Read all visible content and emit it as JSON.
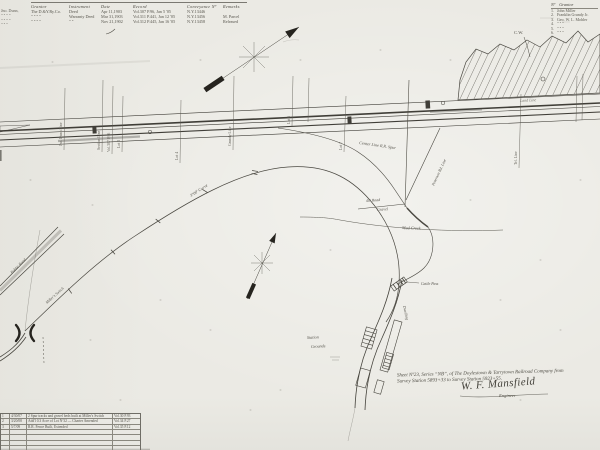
{
  "colors": {
    "paper": "#ebeae4",
    "ink": "#3f3d38",
    "faint": "#77756d"
  },
  "top_table": {
    "margin_notes": [
      "Jno. Dunn,",
      "\" \" \" \"",
      "\" \" \" \"",
      "\" \" \""
    ],
    "headers": [
      "Grantor",
      "Instrument",
      "Date",
      "Record",
      "Conveyance Nº",
      "Remarks"
    ],
    "rows": [
      [
        "The D.&Y.Ry.Co.",
        "Deed",
        "Apr 11,1903",
        "Vol.307 P.96, Jan 5 '05",
        "N.Y.13446",
        ""
      ],
      [
        "\" \" \" \"",
        "Warranty Deed",
        "Mar 31,1903",
        "Vol.311 P.441, Jan 12 '05",
        "N.Y.13456",
        "M. Parcel"
      ],
      [
        "\" \" \" \"",
        "\" \"",
        "Nov 21,1902",
        "Vol.312 P.445, Jan 16 '05",
        "N.Y.13458",
        "Released"
      ]
    ]
  },
  "grantor_list": {
    "no_header": "Nº",
    "name_header": "Grantor",
    "items": [
      {
        "num": "1.",
        "name": "John Miller"
      },
      {
        "num": "2.",
        "name": "Franklin Grundy Jr."
      },
      {
        "num": "3.",
        "name": "Geo. W. L. Mohler"
      },
      {
        "num": "4.",
        "name": "\"   \"   \""
      },
      {
        "num": "5.",
        "name": "\"   \"   \""
      },
      {
        "num": "6.",
        "name": "\"   \"   \""
      }
    ]
  },
  "map_labels": {
    "cw": "C.W.",
    "land_line": "Land  Line",
    "center_line_spur": "Center Line R.R. Spur",
    "curve_note": "3°00' Curve",
    "road_40": "40' Road",
    "gravel": "Gravel",
    "mud_creek": "Mud Creek",
    "peterson_line": "Peterson Rd. Line",
    "public_road": "Public Road",
    "millers_switch": "Miller's Switch",
    "station_grounds_1": "Station",
    "station_grounds_2": "Grounds",
    "dwelling": "Dwelling",
    "cattle_pass": "Cattle Pass",
    "crossings": [
      "Jno. Dunn Line",
      "Section Line",
      "Vol.307 P.96",
      "Lot 3",
      "Lot 4",
      "Grundy Line",
      "Lot 6",
      "Lot 7",
      "Tel. Line"
    ]
  },
  "title_block": {
    "line1": "Sheet Nº23, Series “NB”, of The Doylestown & Tarrytown Railroad Company from",
    "line2": "Survey Station 5893+33 to Survey Station 5923+55.",
    "signature": "W. F. Mansfield",
    "signature_role": "Engineer"
  },
  "revision_table": {
    "rows": [
      {
        "no": "1",
        "date": "4/30/07",
        "desc": "2 Spur tracks and gravel beds built at Miller's Switch",
        "ref": "Vol.30 P.93"
      },
      {
        "no": "2",
        "date": "3/20/08",
        "desc": "Add'l 0.3 Acre of Lot Nº32 — Charter Amended",
        "ref": "Vol.34 P.27"
      },
      {
        "no": "3",
        "date": "5/7/09",
        "desc": "R.R. Fence Built, Extended",
        "ref": "Vol.35 P.12"
      },
      {
        "no": "",
        "date": "",
        "desc": "",
        "ref": ""
      },
      {
        "no": "",
        "date": "",
        "desc": "",
        "ref": ""
      },
      {
        "no": "",
        "date": "",
        "desc": "",
        "ref": ""
      },
      {
        "no": "",
        "date": "",
        "desc": "",
        "ref": ""
      },
      {
        "no": "",
        "date": "",
        "desc": "",
        "ref": ""
      }
    ]
  }
}
